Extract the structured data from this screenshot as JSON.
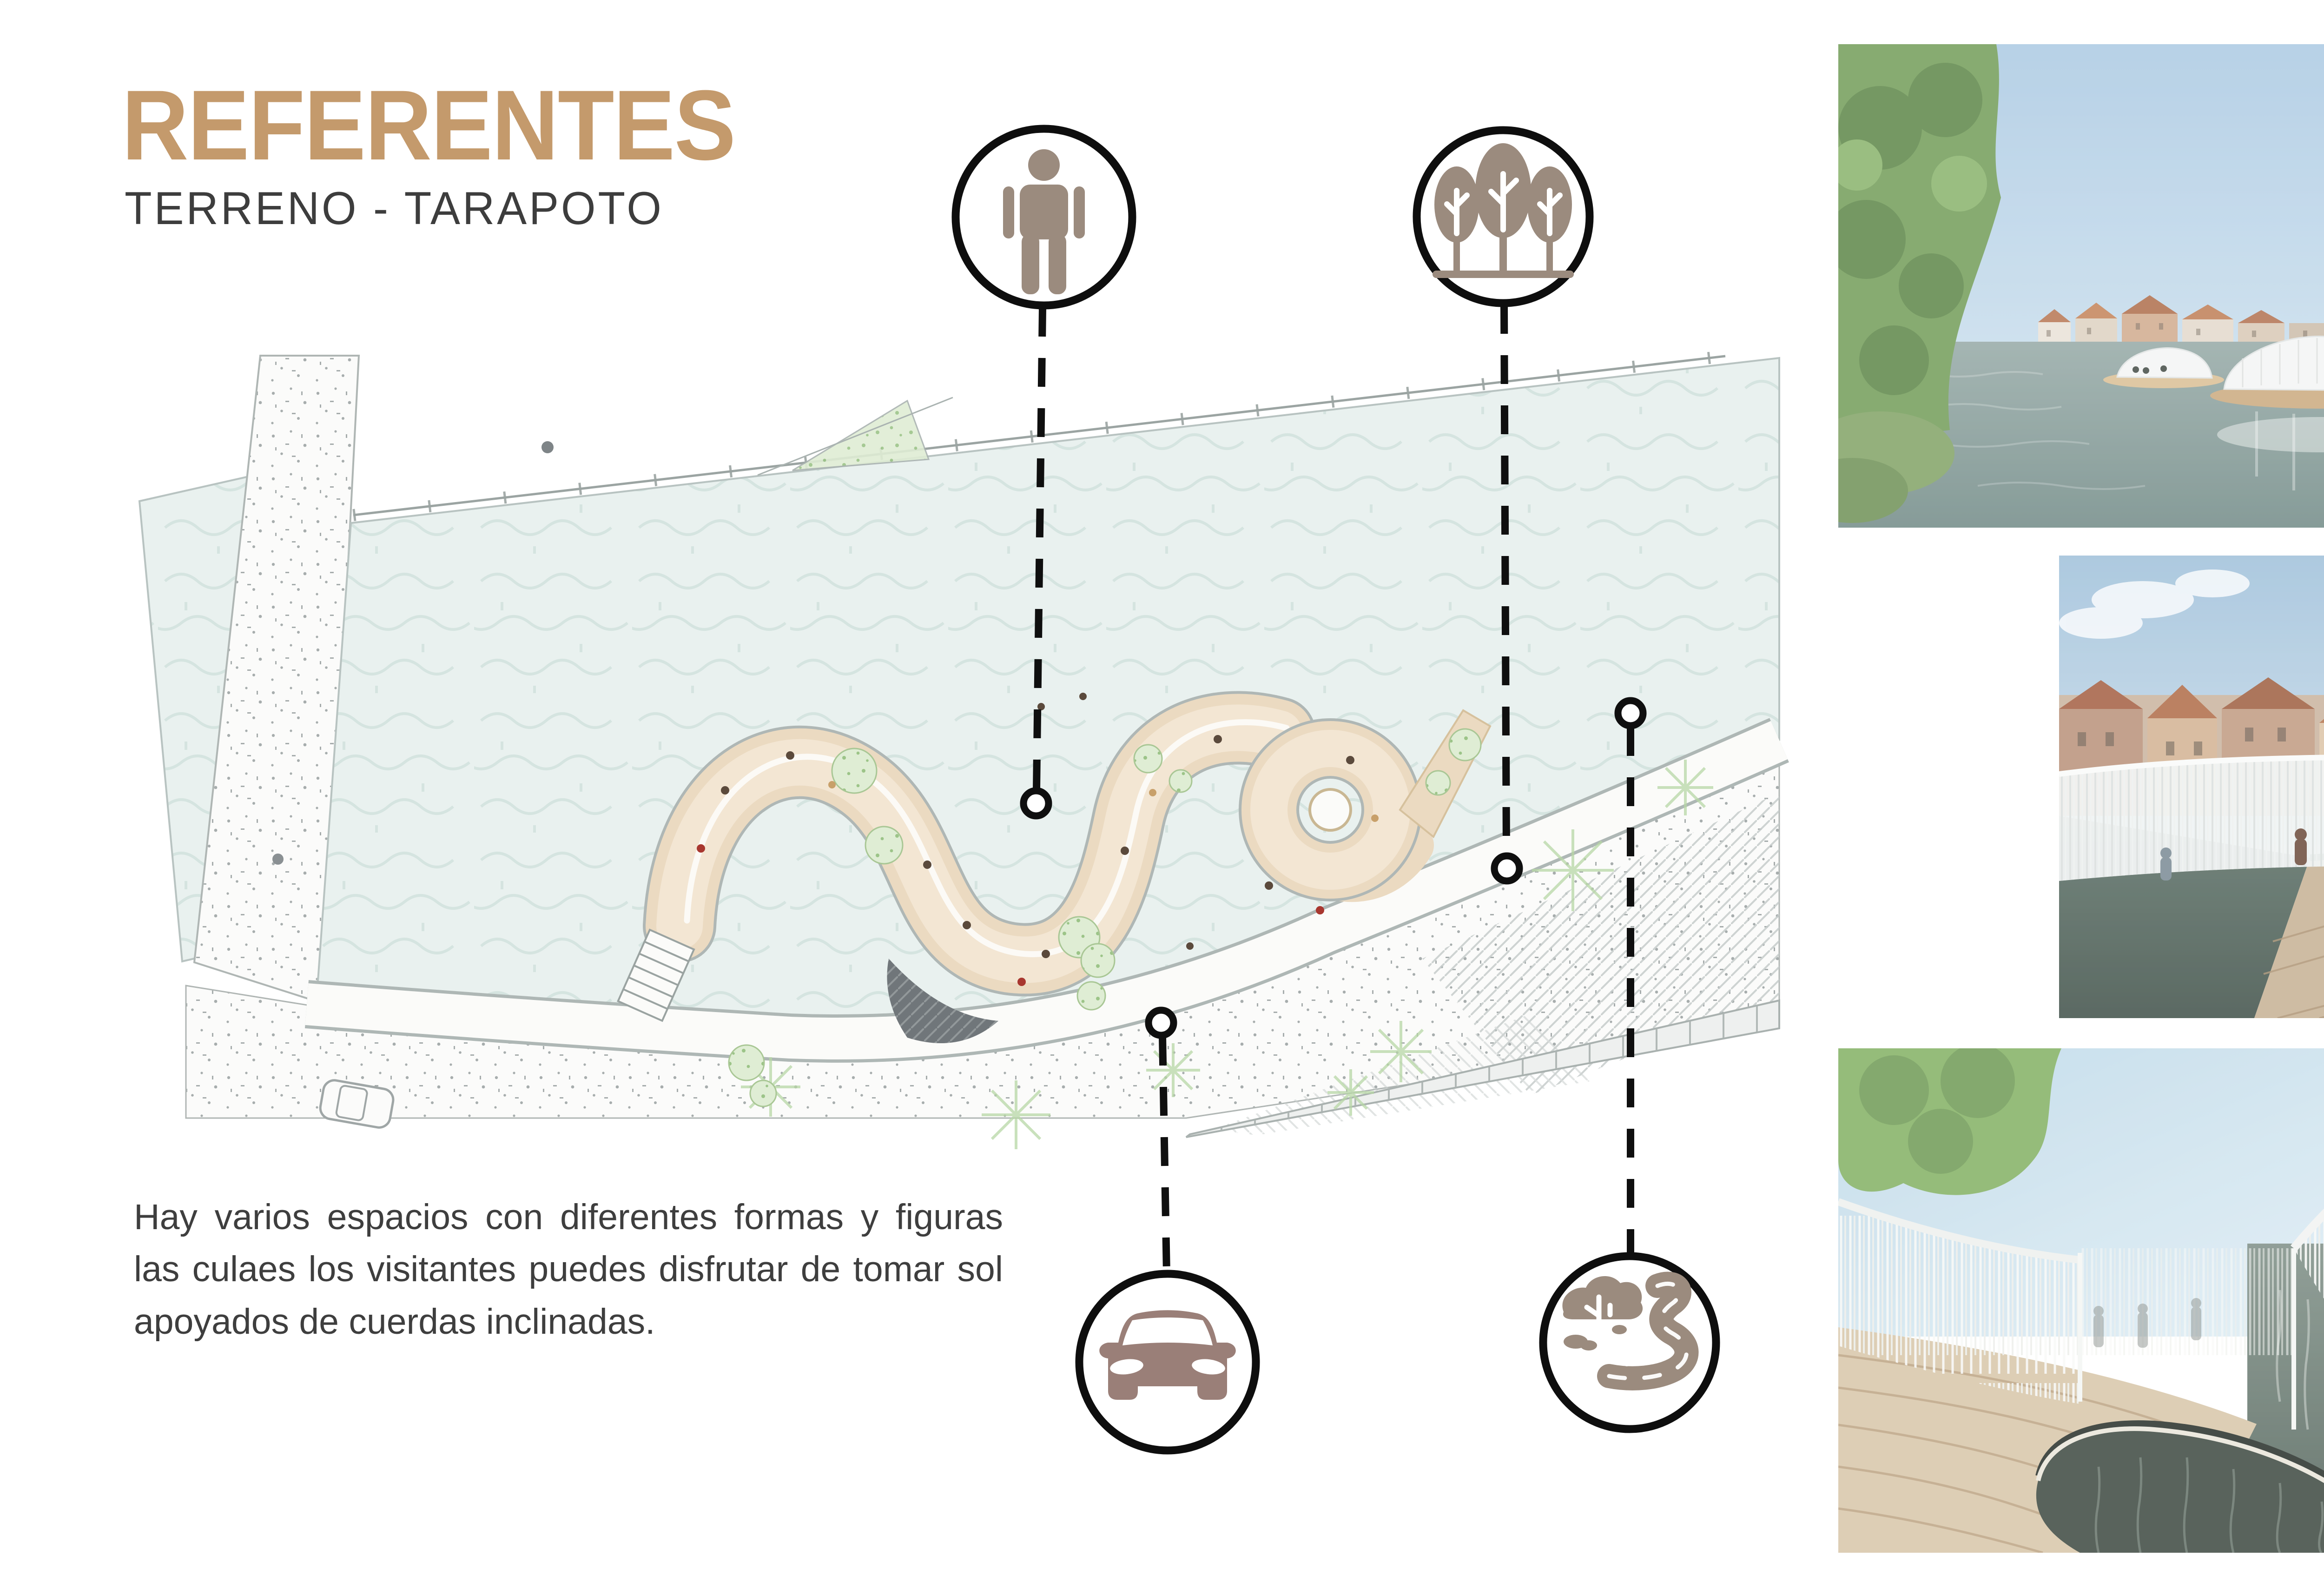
{
  "page": {
    "background": "#ffffff",
    "accent_color": "#C49A6C",
    "text_color": "#3E3E3E",
    "outline_color": "#0E0E0E"
  },
  "header": {
    "title": "REFERENTES",
    "subtitle": "TERRENO - TARAPOTO"
  },
  "description": {
    "text": "Hay varios espacios con diferentes formas y figuras las culaes los visitantes puedes disfrutar de tomar sol apoyados de cuerdas inclinadas."
  },
  "plan": {
    "name": "site-plan-tarapoto",
    "description": "Plano del terreno con pabellon sinuoso de madera junto al malecon, campo verde-azulado, via estipulada y pavimentos achurados",
    "colors": {
      "field": "#E9F1EF",
      "pavilion": "#EBDAC1",
      "pavement_dots": "#A7ADAD",
      "greenery": "#9CC488"
    },
    "annotations": [
      {
        "id": "person",
        "icon": "person-icon",
        "meaning": "peatones"
      },
      {
        "id": "trees",
        "icon": "trees-icon",
        "meaning": "vegetacion"
      },
      {
        "id": "car",
        "icon": "car-icon",
        "meaning": "vehicular"
      },
      {
        "id": "river",
        "icon": "river-icon",
        "meaning": "rio"
      }
    ],
    "icon_fill": "#9B8B7E",
    "car_icon_fill": "#9A7F78"
  },
  "photos": [
    {
      "id": "photo-canal",
      "description": "Canal con pabellon flotante circular de cortinas blancas, casas flamencas y arboles"
    },
    {
      "id": "photo-deck-people",
      "description": "Visitantes sobre plataforma flotante circular con baranda de cuerdas blancas"
    },
    {
      "id": "photo-deck-opening",
      "description": "Entablado de madera con abertura organica al agua y cuerdas blancas colgantes"
    }
  ]
}
